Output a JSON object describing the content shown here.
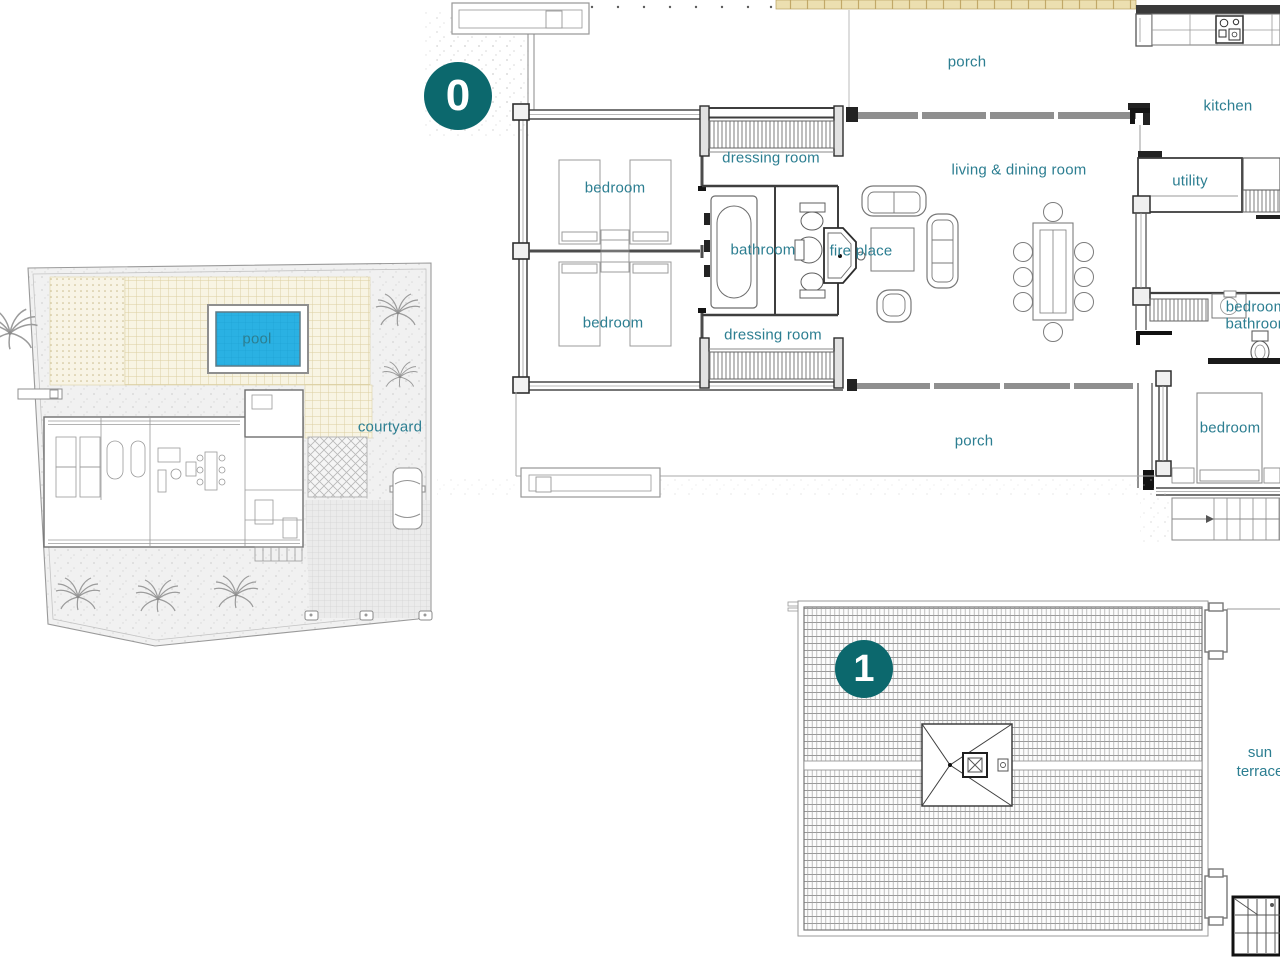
{
  "colors": {
    "label_teal": "#2c7e91",
    "badge_teal": "#0c686d",
    "pool_cyan": "#2ab1e3",
    "pergola_tan": "#ecdfb0"
  },
  "levels": [
    {
      "badge": "0"
    },
    {
      "badge": "1"
    }
  ],
  "site_plan": {
    "labels": {
      "pool": "pool",
      "courtyard": "courtyard"
    }
  },
  "floor0": {
    "rooms": [
      {
        "name": "porch-top",
        "label": "porch"
      },
      {
        "name": "kitchen",
        "label": "kitchen"
      },
      {
        "name": "dressing-room-top",
        "label": "dressing room"
      },
      {
        "name": "bedroom-1",
        "label": "bedroom"
      },
      {
        "name": "living-dining-room",
        "label": "living & dining room"
      },
      {
        "name": "utility",
        "label": "utility"
      },
      {
        "name": "bathroom-main",
        "label": "bathroom"
      },
      {
        "name": "fire-place",
        "label": "fire place"
      },
      {
        "name": "bedroom-2",
        "label": "bedroom"
      },
      {
        "name": "dressing-room-bottom",
        "label": "dressing room"
      },
      {
        "name": "bedroom-3",
        "label": "bedroom"
      },
      {
        "name": "bathroom-2",
        "label": "bathroom"
      },
      {
        "name": "porch-bottom",
        "label": "porch"
      },
      {
        "name": "bedroom-4",
        "label": "bedroom"
      }
    ]
  },
  "floor1": {
    "rooms": [
      {
        "name": "sun-terrace",
        "label": "sun terrace"
      }
    ]
  }
}
